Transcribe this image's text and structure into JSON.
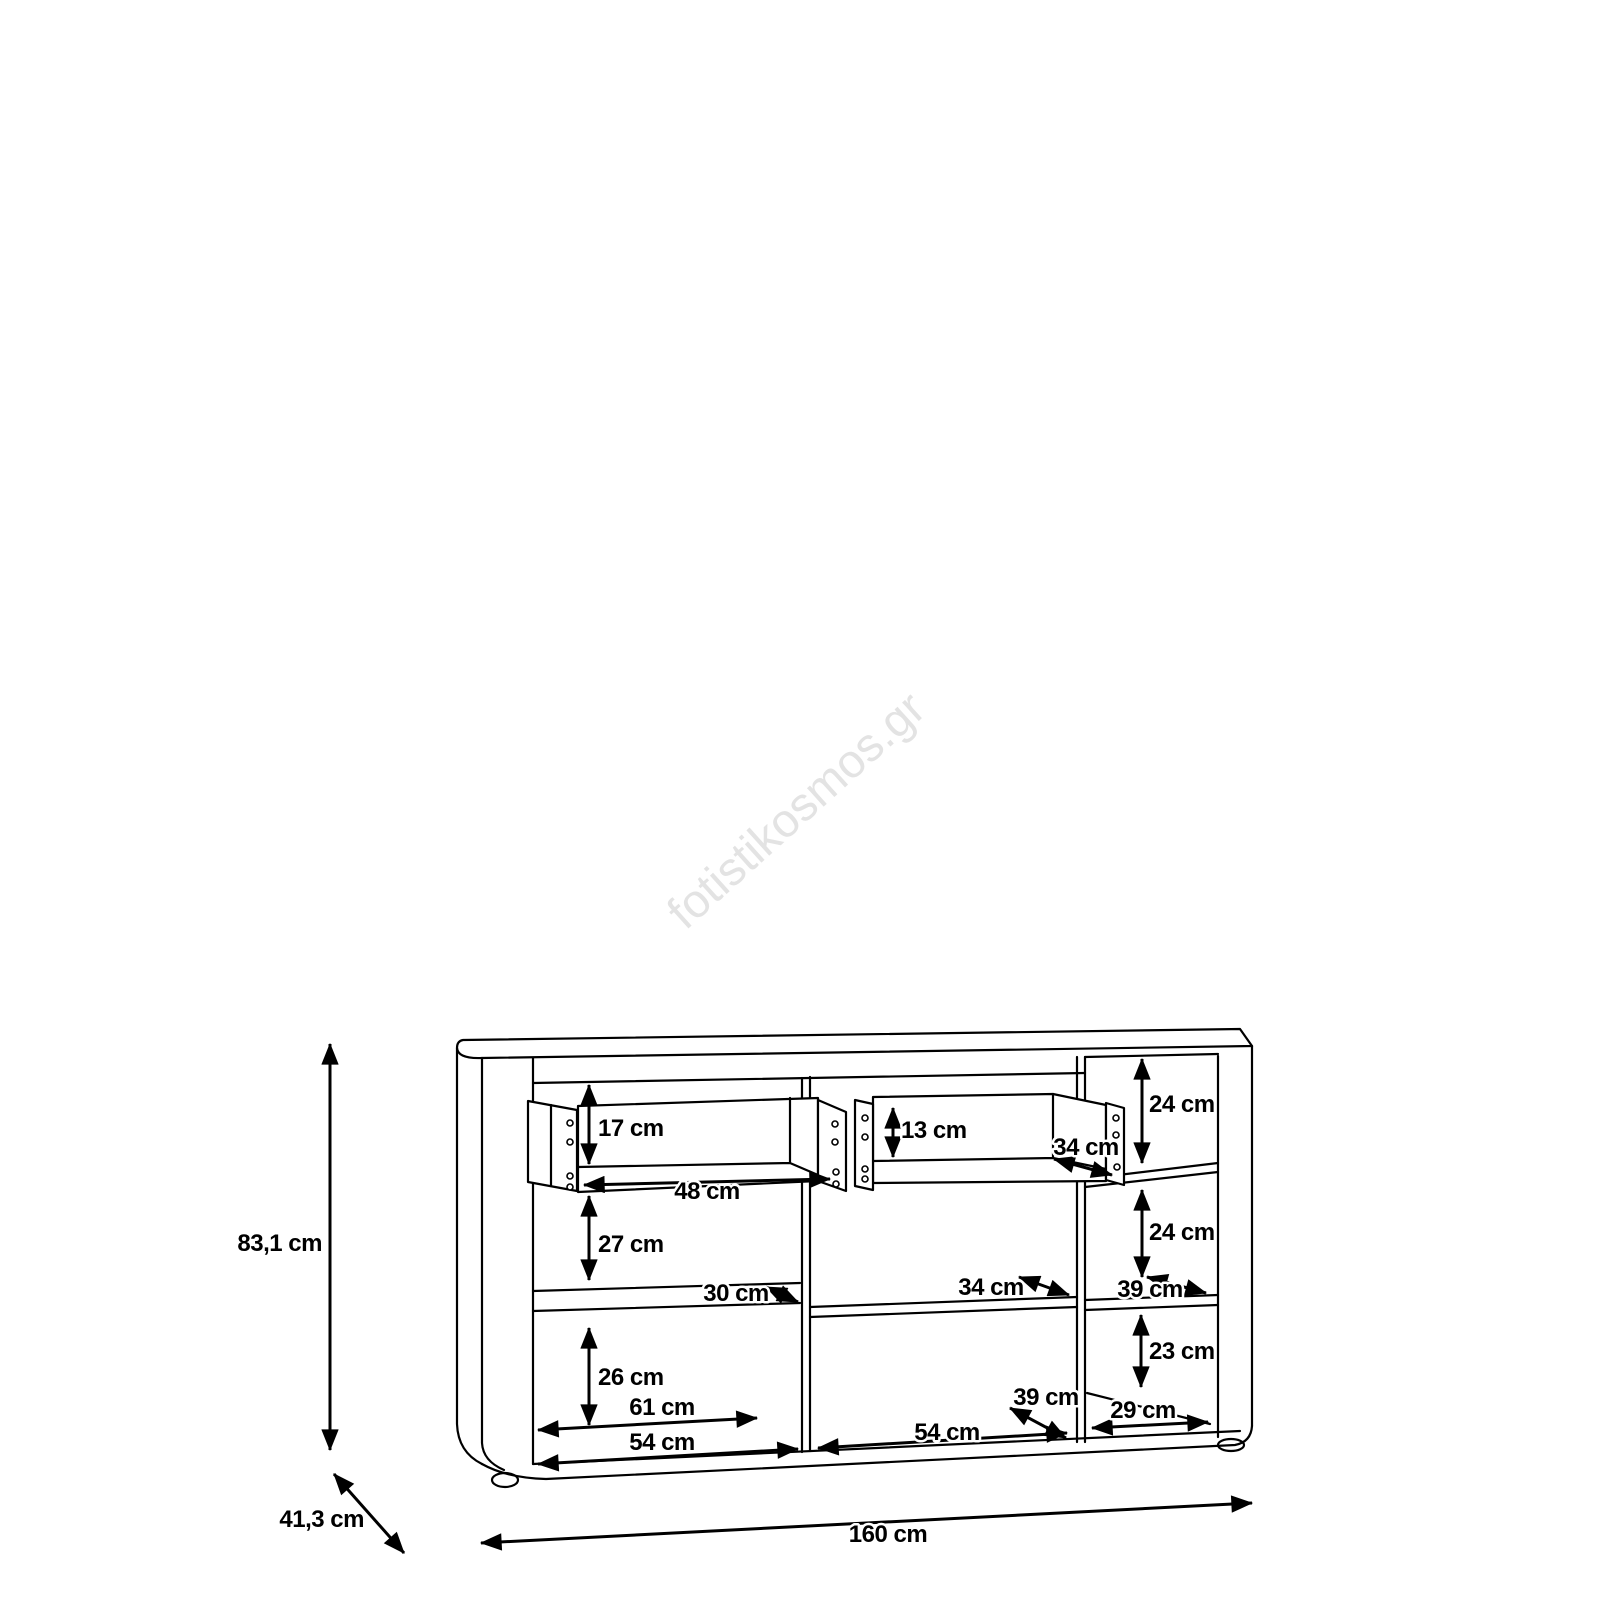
{
  "title": "Sideboard dimension drawing",
  "watermark": {
    "text": "fotistikosmos.gr",
    "color": "#e3e3e3"
  },
  "drawing": {
    "line_color": "#000000",
    "background": "#ffffff"
  },
  "overall": {
    "height": "83,1 cm",
    "depth": "41,3 cm",
    "width": "160 cm"
  },
  "dims": {
    "drawer_left_height": "17 cm",
    "drawer_left_width": "48 cm",
    "left_top_gap": "27 cm",
    "drawer_right_height": "13 cm",
    "drawer_right_depth": "34 cm",
    "right_top_gap": "24 cm",
    "right_mid_gap": "24 cm",
    "left_shelf_depth": "30 cm",
    "center_shelf_depth": "34 cm",
    "right_shelf_depth": "39 cm",
    "left_bottom_gap": "26 cm",
    "right_bottom_gap": "23 cm",
    "left_width_inner": "61 cm",
    "left_section_width": "54 cm",
    "center_floor_depth": "39 cm",
    "center_section_width": "54 cm",
    "right_floor_width": "29 cm"
  }
}
